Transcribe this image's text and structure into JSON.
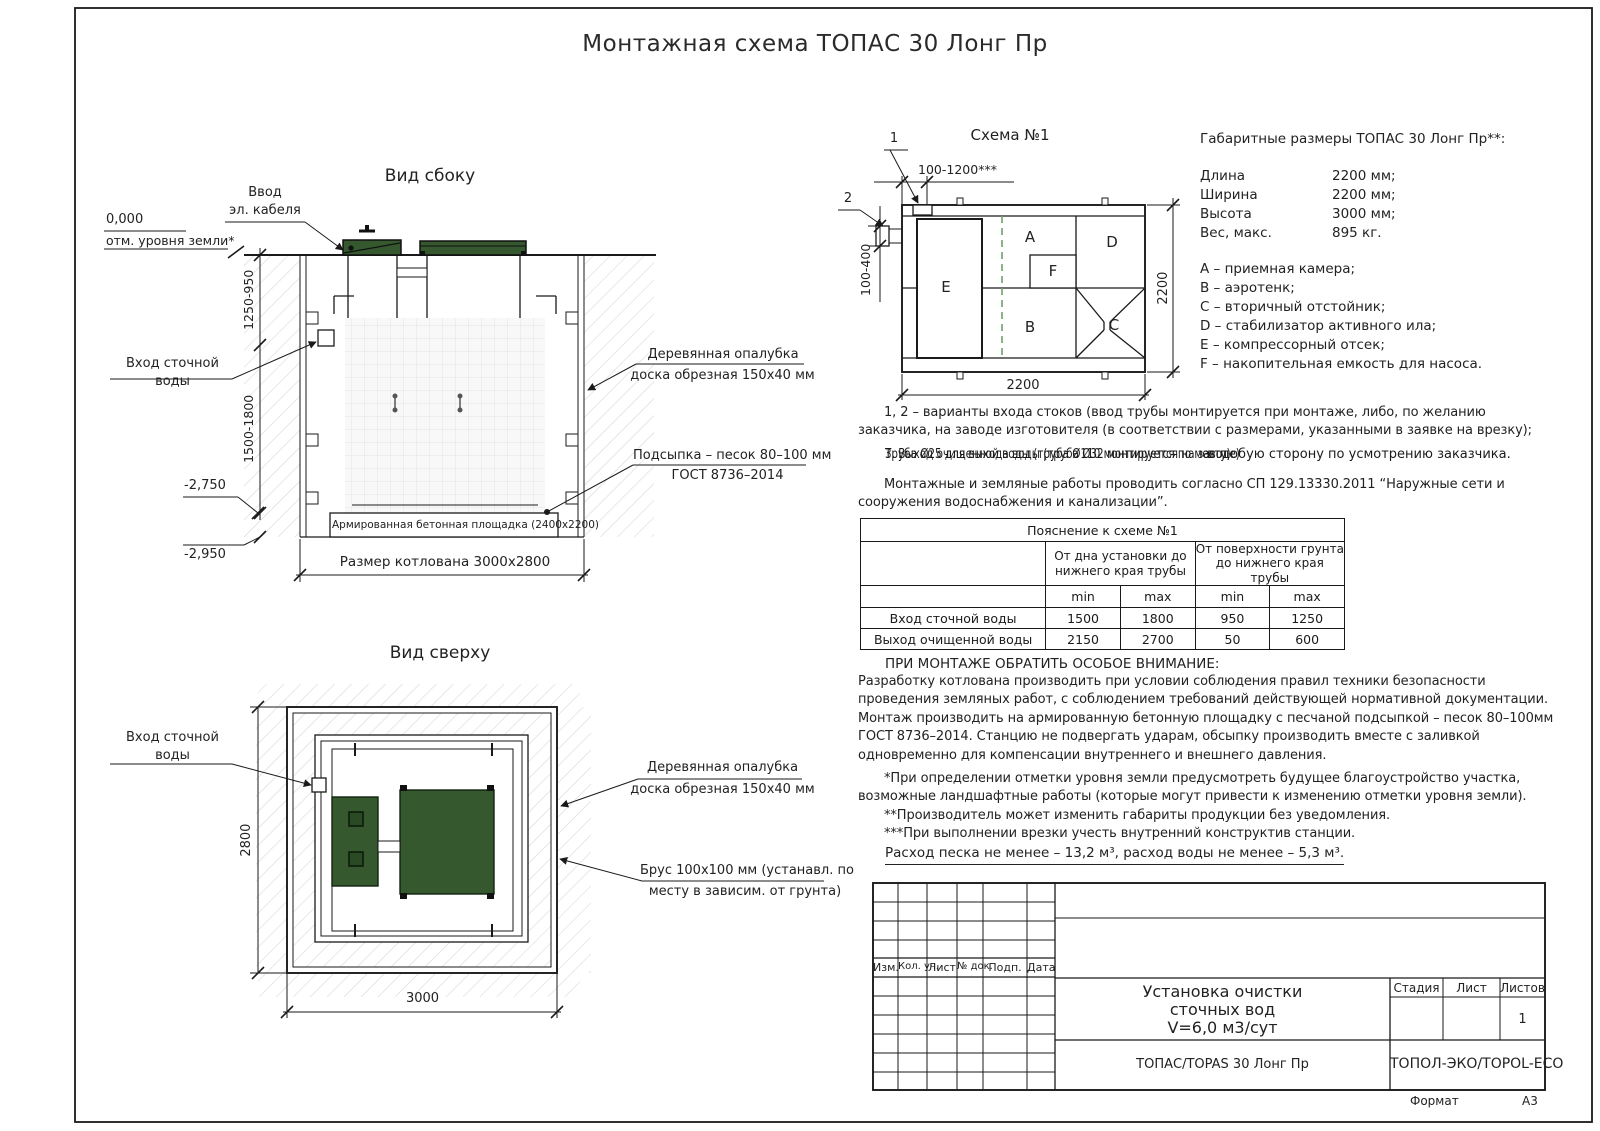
{
  "page_title": "Монтажная схема ТОПАС 30 Лонг Пр",
  "side_view": {
    "title": "Вид сбоку",
    "cable_label_1": "Ввод",
    "cable_label_2": "эл. кабеля",
    "zero_mark": "0,000",
    "ground_mark": "отм. уровня земли*",
    "dim_upper": "1250-950",
    "dim_lower": "1500-1800",
    "inlet_label_1": "Вход сточной",
    "inlet_label_2": "воды",
    "level_pad_top": "-2,750",
    "level_pit_bottom": "-2,950",
    "pad_label": "Армированная бетонная площадка (2400х2200)",
    "pit_dim": "Размер котлована 3000х2800",
    "formwork_label_1": "Деревянная опалубка",
    "formwork_label_2": "доска обрезная 150х40 мм",
    "bedding_label_1": "Подсыпка – песок 80–100 мм",
    "bedding_label_2": "ГОСТ 8736–2014"
  },
  "top_view": {
    "title": "Вид сверху",
    "inlet_label_1": "Вход сточной",
    "inlet_label_2": "воды",
    "formwork_label_1": "Деревянная опалубка",
    "formwork_label_2": "доска обрезная 150х40 мм",
    "beam_label_1": "Брус 100х100 мм (устанавл. по",
    "beam_label_2": "месту в зависим. от грунта)",
    "dim_side": "2800",
    "dim_bottom": "3000"
  },
  "schema": {
    "title": "Схема №1",
    "pointer_1": "1",
    "pointer_2": "2",
    "dim_top": "100-1200***",
    "dim_left": "100-400",
    "dim_right": "2200",
    "dim_bottom": "2200",
    "comp_a": "A",
    "comp_b": "B",
    "comp_c": "C",
    "comp_d": "D",
    "comp_e": "E",
    "comp_f": "F"
  },
  "overall": {
    "title": "Габаритные размеры ТОПАС 30 Лонг Пр**:",
    "rows": [
      {
        "name": "Длина",
        "value": "2200 мм;"
      },
      {
        "name": "Ширина",
        "value": "2200 мм;"
      },
      {
        "name": "Высота",
        "value": "3000 мм;"
      },
      {
        "name": "Вес, макс.",
        "value": "895 кг."
      }
    ],
    "legend": [
      "A – приемная камера;",
      "B – аэротенк;",
      "C – вторичный отстойник;",
      "D – стабилизатор активного ила;",
      "E – компрессорный отсек;",
      "F – накопительная емкость для насоса."
    ]
  },
  "notes": {
    "variants": "1, 2 – варианты входа  стоков (ввод трубы монтируется при монтаже, либо, по желанию заказчика, на заводе изготовителя (в соответствии с размерами, указанными в заявке на врезку);",
    "overlap_a": "Труба Ø25 для выхода воды (труба Ø32 монтируется на заводе)",
    "overlap_b": "3. Выход очищенной воды (труба Ø110 монтируется по месту)",
    "overlap_tail": "в любую сторону по усмотрению заказчика.",
    "works": "Монтажные и земляные работы проводить согласно СП 129.13330.2011 “Наружные сети и сооружения водоснабжения и канализации”."
  },
  "table": {
    "title": "Пояснение к схеме №1",
    "group_1": "От дна установки до нижнего края трубы",
    "group_2": "От поверхности грунта до нижнего края трубы",
    "min_label": "min",
    "max_label": "max",
    "rows": [
      {
        "name": "Вход сточной воды",
        "v1": "1500",
        "v2": "1800",
        "v3": "950",
        "v4": "1250"
      },
      {
        "name": "Выход очищенной воды",
        "v1": "2150",
        "v2": "2700",
        "v3": "50",
        "v4": "600"
      }
    ]
  },
  "attention": {
    "heading": "ПРИ МОНТАЖЕ ОБРАТИТЬ ОСОБОЕ ВНИМАНИЕ:",
    "body": "Разработку котлована производить при условии соблюдения правил техники безопасности проведения земляных работ, с соблюдением требований действующей нормативной документации.  Монтаж производить на армированную бетонную площадку с песчаной подсыпкой – песок 80–100мм ГОСТ 8736–2014. Станцию не подвергать ударам, обсыпку производить вместе с заливкой одновременно для компенсации внутреннего и внешнего давления.",
    "note_1": "*При определении отметки уровня земли предусмотреть будущее благоустройство участка, возможные ландшафтные работы (которые могут привести к изменению отметки уровня земли).",
    "note_2": "**Производитель может изменить габариты продукции без уведомления.",
    "note_3": "***При выполнении врезки учесть внутренний конструктив станции.",
    "consumption": "Расход песка не менее – 13,2 м³, расход воды не менее – 5,3 м³."
  },
  "title_block": {
    "headers": [
      "Изм.",
      "Кол. уч.",
      "Лист",
      "№ док.",
      "Подп.",
      "Дата"
    ],
    "doc_title_1": "Установка очистки",
    "doc_title_2": "сточных вод",
    "doc_title_3": "V=6,0 м3/сут",
    "stage_label": "Стадия",
    "sheet_label": "Лист",
    "sheets_label": "Листов",
    "sheets_value": "1",
    "product": "ТОПАС/TOPAS 30 Лонг Пр",
    "company": "ТОПОЛ-ЭКО/TOPOL-ECO",
    "format_label": "Формат",
    "format_value": "А3"
  },
  "colors": {
    "lid_green": "#35582e",
    "lid_green_dark": "#2a4a24",
    "dashed_green": "#6f9e6f",
    "line": "#1a1a1a"
  }
}
